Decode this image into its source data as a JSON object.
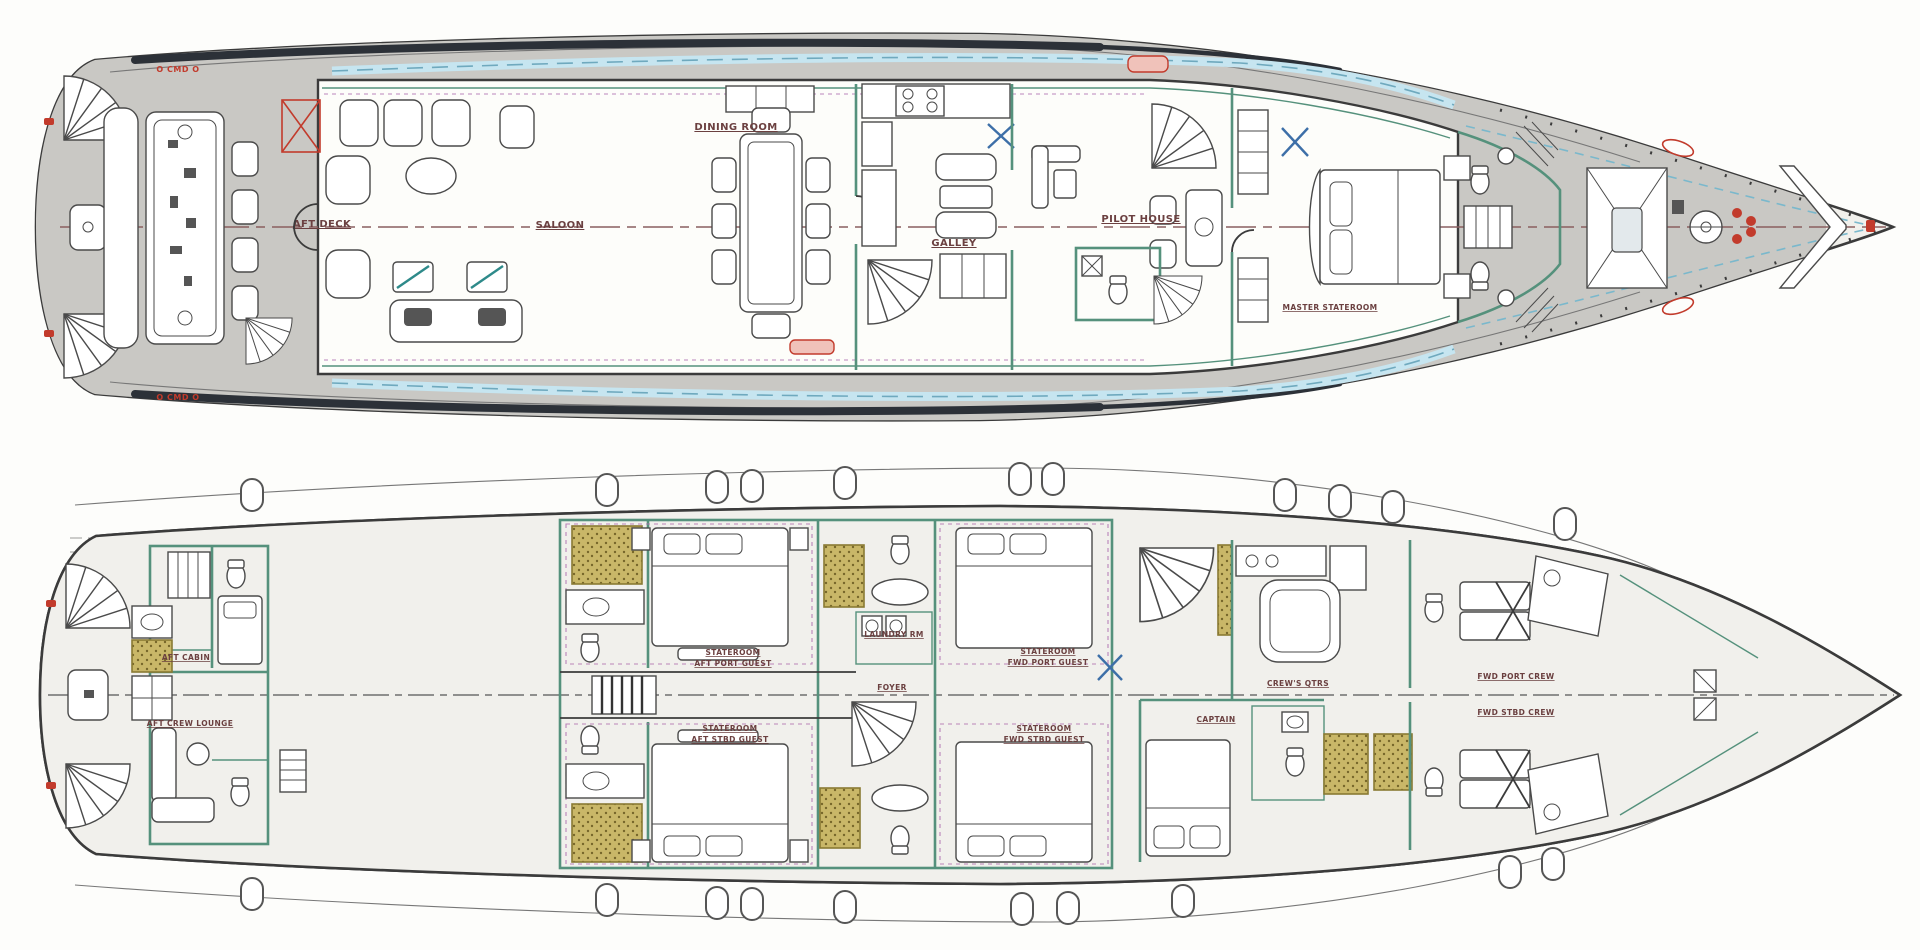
{
  "drawing": {
    "type": "yacht-deck-plan-scan",
    "decks_shown": 2
  },
  "colors": {
    "paper": "#fdfdfb",
    "deck_gray": "#c9c8c4",
    "wall_dark": "#3b3b3b",
    "bulkhead_green": "#55917c",
    "window_blue": "#c6e5f0",
    "shower_gold": "#c9b768",
    "accent_red": "#c23b2c",
    "accent_magenta": "#b070b0",
    "centerline_maroon": "#8a5f5f"
  },
  "main_deck": {
    "labels": {
      "aft_deck": "AFT DECK",
      "saloon": "SALOON",
      "dining_room": "DINING ROOM",
      "galley": "GALLEY",
      "pilot_house": "PILOT HOUSE",
      "master_stateroom": "MASTER STATEROOM",
      "cmd_port": "O CMD O",
      "cmd_stbd": "O CMD O"
    }
  },
  "lower_deck": {
    "labels": {
      "aft_cabin": "AFT CABIN",
      "aft_crew_lounge": "AFT CREW LOUNGE",
      "stateroom_aft_port_line1": "STATEROOM",
      "stateroom_aft_port_line2": "AFT PORT GUEST",
      "stateroom_aft_stbd_line1": "STATEROOM",
      "stateroom_aft_stbd_line2": "AFT STBD GUEST",
      "laundry": "LAUNDRY RM",
      "foyer": "FOYER",
      "stateroom_fwd_port_line1": "STATEROOM",
      "stateroom_fwd_port_line2": "FWD PORT GUEST",
      "stateroom_fwd_stbd_line1": "STATEROOM",
      "stateroom_fwd_stbd_line2": "FWD STBD GUEST",
      "captain": "CAPTAIN",
      "crews_qtrs": "CREW'S QTRS",
      "fwd_port_crew": "FWD PORT CREW",
      "fwd_stbd_crew": "FWD STBD CREW"
    }
  }
}
